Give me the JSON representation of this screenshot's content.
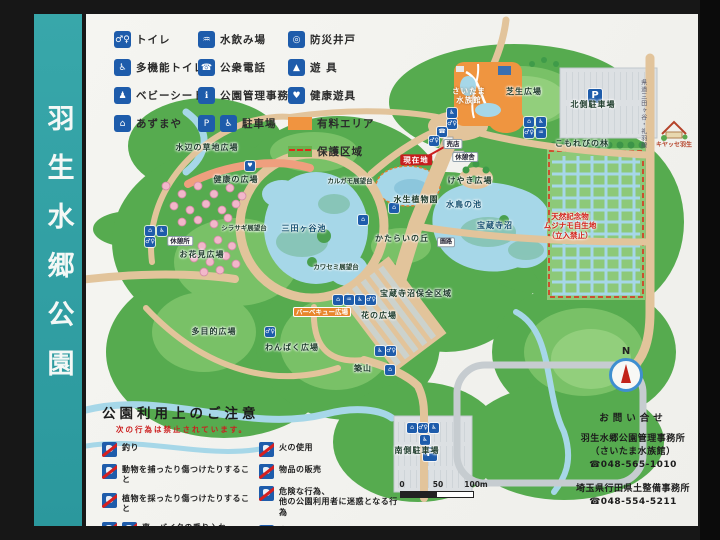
{
  "sign": {
    "title": "羽生水郷公園"
  },
  "colors": {
    "title_bar": "#2fa0a5",
    "icon_blue": "#1e5cab",
    "paid_area": "#f09440",
    "protected_area": "#6ab04c",
    "prohibition_red": "#d61f1f",
    "current_location_red": "#c81e1e"
  },
  "legend": {
    "col1": [
      {
        "label": "トイレ",
        "glyph": "♂♀",
        "icon_name": "toilet-icon"
      },
      {
        "label": "多機能トイレ",
        "glyph": "♿",
        "icon_name": "accessible-toilet-icon"
      },
      {
        "label": "ベビーシート",
        "glyph": "♟",
        "icon_name": "baby-seat-icon"
      },
      {
        "label": "あずまや",
        "glyph": "⌂",
        "icon_name": "gazebo-icon"
      }
    ],
    "col2": [
      {
        "label": "水飲み場",
        "glyph": "♒",
        "icon_name": "drinking-fountain-icon"
      },
      {
        "label": "公衆電話",
        "glyph": "☎",
        "icon_name": "public-phone-icon"
      },
      {
        "label": "公園管理事務所",
        "glyph": "ℹ",
        "icon_name": "park-office-icon"
      },
      {
        "label": "駐車場",
        "glyph": "P",
        "glyph2": "♿",
        "icon_name": "parking-icon"
      }
    ],
    "col3": [
      {
        "label": "防災井戸",
        "glyph": "◎",
        "icon_name": "disaster-well-icon"
      },
      {
        "label": "遊 具",
        "glyph": "▲",
        "icon_name": "playground-icon"
      },
      {
        "label": "健康遊具",
        "glyph": "♥",
        "icon_name": "health-equipment-icon"
      }
    ],
    "areas": [
      {
        "label": "有料エリア",
        "color": "#f09440",
        "type": "paid"
      },
      {
        "label": "保護区域",
        "color": "#6ab04c",
        "type": "protected"
      }
    ]
  },
  "map": {
    "compass_n": "N",
    "scale": {
      "t0": "0",
      "t1": "50",
      "t2": "100m"
    },
    "labels": [
      {
        "text": "水辺の草地広場",
        "x": 121,
        "y": 134,
        "kind": "plain"
      },
      {
        "text": "健康の広場",
        "x": 150,
        "y": 166,
        "kind": "plain"
      },
      {
        "text": "シラサギ展望台",
        "x": 158,
        "y": 214,
        "kind": "tiny"
      },
      {
        "text": "休憩所",
        "x": 94,
        "y": 227,
        "kind": "badge"
      },
      {
        "text": "お花見広場",
        "x": 116,
        "y": 241,
        "kind": "plain"
      },
      {
        "text": "三田ヶ谷池",
        "x": 218,
        "y": 215,
        "kind": "pond"
      },
      {
        "text": "カルガモ展望台",
        "x": 264,
        "y": 167,
        "kind": "tiny"
      },
      {
        "text": "カワセミ展望台",
        "x": 250,
        "y": 253,
        "kind": "tiny"
      },
      {
        "text": "水生植物園",
        "x": 330,
        "y": 186,
        "kind": "plain"
      },
      {
        "text": "現在地",
        "x": 330,
        "y": 146,
        "kind": "red-badge"
      },
      {
        "text": "売店",
        "x": 367,
        "y": 130,
        "kind": "badge"
      },
      {
        "text": "休憩舎",
        "x": 379,
        "y": 143,
        "kind": "badge"
      },
      {
        "text": "けやき広場",
        "x": 384,
        "y": 167,
        "kind": "plain"
      },
      {
        "text": "さいたま\n水族館",
        "x": 383,
        "y": 82,
        "kind": "white"
      },
      {
        "text": "芝生広場",
        "x": 438,
        "y": 78,
        "kind": "plain"
      },
      {
        "text": "北側駐車場",
        "x": 507,
        "y": 91,
        "kind": "plain"
      },
      {
        "text": "水鳥の池",
        "x": 378,
        "y": 191,
        "kind": "pond"
      },
      {
        "text": "宝蔵寺沼",
        "x": 409,
        "y": 212,
        "kind": "pond"
      },
      {
        "text": "かたらいの丘",
        "x": 316,
        "y": 225,
        "kind": "plain"
      },
      {
        "text": "園路",
        "x": 360,
        "y": 228,
        "kind": "badge-tiny"
      },
      {
        "text": "宝蔵寺沼保全区域",
        "x": 330,
        "y": 280,
        "kind": "plain"
      },
      {
        "text": "花の広場",
        "x": 293,
        "y": 302,
        "kind": "plain"
      },
      {
        "text": "バーベキュー広場",
        "x": 236,
        "y": 298,
        "kind": "orange-badge"
      },
      {
        "text": "多目的広場",
        "x": 128,
        "y": 318,
        "kind": "plain"
      },
      {
        "text": "わんぱく広場",
        "x": 206,
        "y": 334,
        "kind": "plain"
      },
      {
        "text": "築山",
        "x": 277,
        "y": 355,
        "kind": "plain"
      },
      {
        "text": "南側駐車場",
        "x": 331,
        "y": 437,
        "kind": "plain"
      },
      {
        "text": "こもれびの林",
        "x": 496,
        "y": 130,
        "kind": "plain"
      },
      {
        "text": "天然記念物\nムジナモ自生地\n（立入禁止）",
        "x": 484,
        "y": 212,
        "kind": "red-text"
      },
      {
        "text": "キヤッセ羽生",
        "x": 588,
        "y": 131,
        "kind": "logo-text"
      },
      {
        "text": "県道三田ヶ谷・礼羽線",
        "x": 557,
        "y": 100,
        "kind": "vertical"
      }
    ],
    "markers": [
      {
        "glyph": "♿",
        "x": 366,
        "y": 99,
        "name": "accessible-toilet-marker"
      },
      {
        "glyph": "♂♀",
        "x": 366,
        "y": 110,
        "name": "toilet-marker"
      },
      {
        "glyph": "☎",
        "x": 356,
        "y": 118,
        "name": "phone-marker"
      },
      {
        "glyph": "♂♀",
        "x": 348,
        "y": 127,
        "name": "toilet-marker"
      },
      {
        "glyph": "⌂",
        "x": 443,
        "y": 108,
        "name": "gazebo-marker"
      },
      {
        "glyph": "♿",
        "x": 455,
        "y": 108,
        "name": "accessible-toilet-marker"
      },
      {
        "glyph": "♂♀",
        "x": 443,
        "y": 119,
        "name": "toilet-marker"
      },
      {
        "glyph": "♒",
        "x": 455,
        "y": 119,
        "name": "drinking-fountain-marker"
      },
      {
        "glyph": "P",
        "x": 509,
        "y": 82,
        "size": "lg",
        "name": "north-parking-marker"
      },
      {
        "glyph": "⌂",
        "x": 64,
        "y": 217,
        "name": "gazebo-marker"
      },
      {
        "glyph": "♿",
        "x": 76,
        "y": 217,
        "name": "accessible-toilet-marker"
      },
      {
        "glyph": "♂♀",
        "x": 64,
        "y": 228,
        "name": "toilet-marker"
      },
      {
        "glyph": "⌂",
        "x": 277,
        "y": 206,
        "name": "gazebo-marker"
      },
      {
        "glyph": "⌂",
        "x": 308,
        "y": 194,
        "name": "gazebo-marker"
      },
      {
        "glyph": "♥",
        "x": 164,
        "y": 152,
        "name": "health-equipment-marker"
      },
      {
        "glyph": "♂♀",
        "x": 184,
        "y": 318,
        "name": "toilet-marker"
      },
      {
        "glyph": "⌂",
        "x": 252,
        "y": 286,
        "name": "gazebo-marker"
      },
      {
        "glyph": "♒",
        "x": 263,
        "y": 286,
        "name": "drinking-fountain-marker"
      },
      {
        "glyph": "♿",
        "x": 274,
        "y": 286,
        "name": "accessible-toilet-marker"
      },
      {
        "glyph": "♂♀",
        "x": 285,
        "y": 286,
        "name": "toilet-marker"
      },
      {
        "glyph": "♿",
        "x": 294,
        "y": 337,
        "name": "accessible-toilet-marker"
      },
      {
        "glyph": "♂♀",
        "x": 305,
        "y": 337,
        "name": "toilet-marker"
      },
      {
        "glyph": "⌂",
        "x": 304,
        "y": 356,
        "name": "gazebo-marker"
      },
      {
        "glyph": "⌂",
        "x": 326,
        "y": 414,
        "name": "gazebo-marker"
      },
      {
        "glyph": "♂♀",
        "x": 337,
        "y": 414,
        "name": "toilet-marker"
      },
      {
        "glyph": "♿",
        "x": 348,
        "y": 414,
        "name": "accessible-toilet-marker"
      },
      {
        "glyph": "♿",
        "x": 339,
        "y": 426,
        "name": "accessible-toilet-marker"
      },
      {
        "glyph": "P",
        "x": 344,
        "y": 440,
        "size": "lg",
        "name": "south-parking-marker"
      }
    ]
  },
  "notices": {
    "title": "公園利用上のご注意",
    "subtitle": "次の行為は禁止されています。",
    "col1": [
      {
        "text": "釣り",
        "double": false,
        "name": "no-fishing-rule"
      },
      {
        "text": "動物を捕ったり傷つけたりすること",
        "double": false,
        "name": "no-catching-animals-rule"
      },
      {
        "text": "植物を採ったり傷つけたりすること",
        "double": false,
        "name": "no-picking-plants-rule"
      },
      {
        "text": "車、バイクの乗り入れ",
        "double": true,
        "name": "no-vehicles-rule"
      }
    ],
    "col2": [
      {
        "text": "火の使用",
        "double": false,
        "name": "no-fire-rule"
      },
      {
        "text": "物品の販売",
        "double": false,
        "name": "no-selling-rule"
      },
      {
        "text": "危険な行為、\n他の公園利用者に迷惑となる行為",
        "double": false,
        "name": "no-dangerous-acts-rule"
      },
      {
        "text": "犬はリードでつないでください\n犬のふんは持ち帰りましょう",
        "double": false,
        "name": "dog-rules"
      }
    ]
  },
  "contact": {
    "title": "お問い合せ",
    "blocks": [
      {
        "line1": "羽生水郷公園管理事務所",
        "line2": "（さいたま水族館）",
        "phone": "☎048-565-1010"
      },
      {
        "line1": "埼玉県行田県土整備事務所",
        "line2": "",
        "phone": "☎048-554-5211"
      }
    ]
  }
}
